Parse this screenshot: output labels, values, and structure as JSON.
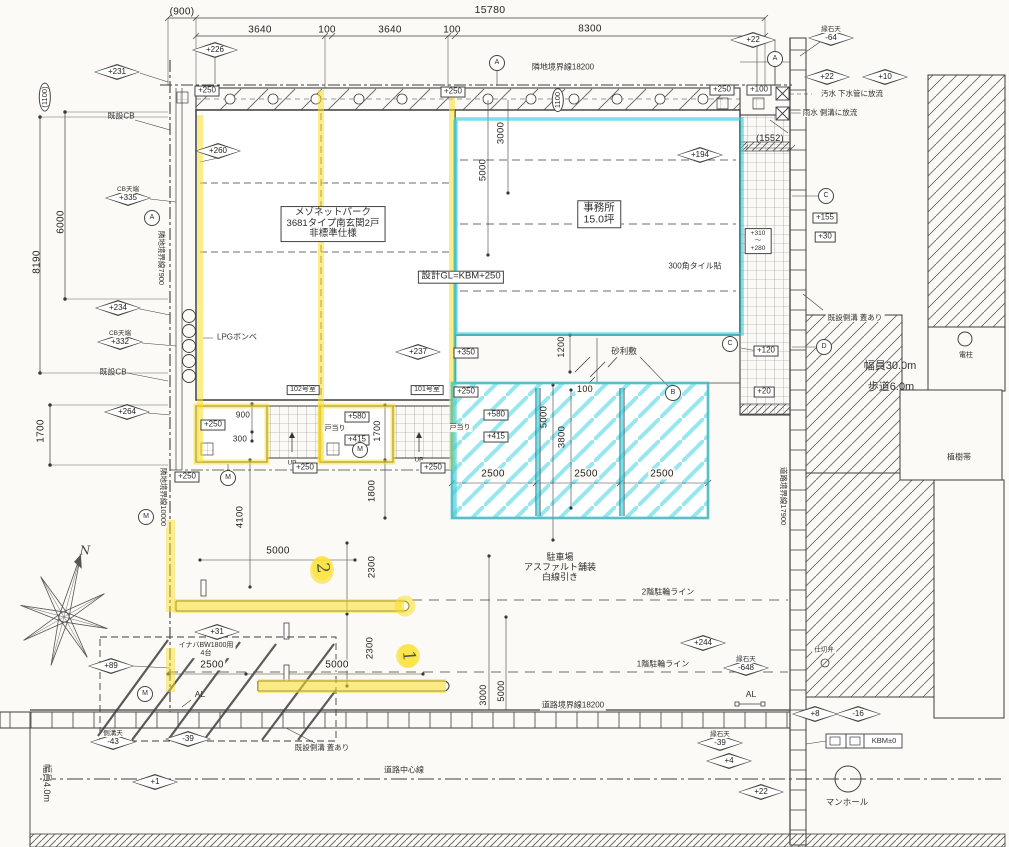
{
  "drawing": {
    "type": "site-plan",
    "accent_yellow": "#f8e23c",
    "accent_cyan": "#44d2e2",
    "line_color": "#3f3f3f"
  },
  "labels": [
    {
      "n": "dim-900",
      "t": "(900)",
      "x": 182,
      "y": 12,
      "k": "dim",
      "s": 10
    },
    {
      "n": "dim-15780",
      "t": "15780",
      "x": 490,
      "y": 11,
      "k": "dim",
      "s": 10.5
    },
    {
      "n": "dim-3640-a",
      "t": "3640",
      "x": 260,
      "y": 30,
      "k": "dim",
      "s": 10
    },
    {
      "n": "dim-100-a",
      "t": "100",
      "x": 327,
      "y": 30,
      "k": "dim",
      "s": 10
    },
    {
      "n": "dim-3640-b",
      "t": "3640",
      "x": 390,
      "y": 30,
      "k": "dim",
      "s": 10
    },
    {
      "n": "dim-100-b",
      "t": "100",
      "x": 452,
      "y": 30,
      "k": "dim",
      "s": 10
    },
    {
      "n": "dim-8300",
      "t": "8300",
      "x": 590,
      "y": 29,
      "k": "dim",
      "s": 10
    },
    {
      "n": "dim-1100-left",
      "t": "(1100)",
      "x": 45,
      "y": 97,
      "k": "oval",
      "r": -90
    },
    {
      "n": "dim-6000",
      "t": "6000",
      "x": 61,
      "y": 222,
      "k": "dim",
      "r": -90,
      "s": 10
    },
    {
      "n": "dim-8190",
      "t": "8190",
      "x": 37,
      "y": 262,
      "k": "dim",
      "r": -90,
      "s": 10
    },
    {
      "n": "dim-1700-left",
      "t": "1700",
      "x": 41,
      "y": 431,
      "k": "dim",
      "r": -90,
      "s": 10
    },
    {
      "n": "boundary-top",
      "t": "隣地境界線18200",
      "x": 563,
      "y": 68,
      "k": "note",
      "s": 8,
      "bg": 1
    },
    {
      "n": "boundary-left-upper",
      "t": "隣地境界線7900",
      "x": 161,
      "y": 258,
      "k": "note",
      "s": 7.5,
      "r": 90,
      "bg": 1
    },
    {
      "n": "boundary-left-lower",
      "t": "隣地境界線10000",
      "x": 163,
      "y": 497,
      "k": "note",
      "s": 7.5,
      "r": 90,
      "bg": 1
    },
    {
      "n": "boundary-right",
      "t": "道路境界線17900",
      "x": 783,
      "y": 496,
      "k": "note",
      "s": 7.5,
      "r": 90,
      "bg": 1
    },
    {
      "n": "boundary-bottom",
      "t": "道路境界線18200",
      "x": 573,
      "y": 706,
      "k": "note",
      "s": 8,
      "bg": 1
    },
    {
      "n": "road-centerline-label",
      "t": "道路中心線",
      "x": 404,
      "y": 771,
      "k": "note",
      "s": 8,
      "bg": 1
    },
    {
      "n": "road-width-bottom",
      "t": "幅員4.0m",
      "x": 47,
      "y": 783,
      "k": "note",
      "s": 9,
      "r": 90,
      "bg": 1
    },
    {
      "n": "road-width-right",
      "t": "幅員30.0m",
      "x": 890,
      "y": 366,
      "k": "note",
      "s": 11
    },
    {
      "n": "sidewalk-width",
      "t": "歩道6.0m",
      "x": 891,
      "y": 387,
      "k": "note",
      "s": 11
    },
    {
      "n": "building-title",
      "lines": [
        "メゾネットパーク",
        "3681タイプ南玄関2戸",
        "非標準仕様"
      ],
      "hl": 0,
      "x": 333,
      "y": 224,
      "k": "boxm",
      "s": 9.5
    },
    {
      "n": "office-label",
      "lines": [
        "事務所",
        "15.0坪"
      ],
      "x": 599,
      "y": 214,
      "k": "boxm",
      "s": 10.5
    },
    {
      "n": "design-gl",
      "t": "設計GL=KBM+250",
      "x": 461,
      "y": 277,
      "k": "box",
      "s": 9.5
    },
    {
      "n": "tile-note",
      "t": "300角タイル貼",
      "x": 695,
      "y": 267,
      "k": "note",
      "s": 8
    },
    {
      "n": "gravel-note",
      "t": "砂利敷",
      "x": 624,
      "y": 352,
      "k": "note",
      "s": 8.5,
      "bg": 1
    },
    {
      "n": "room-102",
      "t": "102号室",
      "x": 303,
      "y": 390,
      "k": "box",
      "s": 7
    },
    {
      "n": "room-101",
      "t": "101号室",
      "x": 427,
      "y": 390,
      "k": "box",
      "s": 7
    },
    {
      "n": "doorstop-102",
      "t": "戸当り",
      "x": 335,
      "y": 429,
      "k": "note",
      "s": 7,
      "bg": 1
    },
    {
      "n": "doorstop-101",
      "t": "戸当り",
      "x": 460,
      "y": 428,
      "k": "note",
      "s": 7,
      "bg": 1
    },
    {
      "n": "up-102",
      "t": "UP",
      "x": 292,
      "y": 463,
      "k": "note",
      "s": 6.5
    },
    {
      "n": "up-101",
      "t": "UP",
      "x": 419,
      "y": 460,
      "k": "note",
      "s": 6.5
    },
    {
      "n": "parking-label",
      "lines": [
        "駐車場",
        "アスファルト舗装",
        "白線引き"
      ],
      "x": 560,
      "y": 567,
      "k": "multi",
      "s": 9
    },
    {
      "n": "line-2f",
      "t": "2階駐輪ライン",
      "x": 668,
      "y": 593,
      "k": "note",
      "s": 8,
      "bg": 1
    },
    {
      "n": "line-1f",
      "t": "1階駐輪ライン",
      "x": 663,
      "y": 665,
      "k": "note",
      "s": 8,
      "bg": 1
    },
    {
      "n": "shed-label",
      "lines": [
        "イナバBW1800用",
        "4台"
      ],
      "x": 206,
      "y": 650,
      "k": "multi",
      "s": 7,
      "bg": 1
    },
    {
      "n": "lpg-label",
      "t": "LPGボンベ",
      "x": 237,
      "y": 338,
      "k": "note",
      "s": 8
    },
    {
      "n": "cb-top",
      "t": "既設CB",
      "x": 121,
      "y": 117,
      "k": "note",
      "s": 8
    },
    {
      "n": "cb-bottom",
      "t": "既設CB",
      "x": 113,
      "y": 373,
      "k": "note",
      "s": 8
    },
    {
      "n": "gutter-right",
      "t": "既設側溝 蓋あり",
      "x": 855,
      "y": 318,
      "k": "note",
      "s": 7.5,
      "bg": 1
    },
    {
      "n": "gutter-bottom",
      "t": "既設側溝 蓋あり",
      "x": 322,
      "y": 748,
      "k": "note",
      "s": 7.5,
      "bg": 1
    },
    {
      "n": "sewage-note",
      "t": "汚水 下水管に放流",
      "x": 852,
      "y": 94,
      "k": "note",
      "s": 7.5,
      "bg": 1
    },
    {
      "n": "rain-note",
      "t": "雨水 側溝に放流",
      "x": 830,
      "y": 113,
      "k": "note",
      "s": 7.5,
      "bg": 1
    },
    {
      "n": "planting-label",
      "t": "植樹帯",
      "x": 959,
      "y": 458,
      "k": "note",
      "s": 8
    },
    {
      "n": "pole-label",
      "t": "電柱",
      "x": 966,
      "y": 356,
      "k": "note",
      "s": 7
    },
    {
      "n": "manhole-label",
      "t": "マンホール",
      "x": 847,
      "y": 803,
      "k": "note",
      "s": 8.5
    },
    {
      "n": "valve-label",
      "t": "仕切弁",
      "x": 824,
      "y": 650,
      "k": "note",
      "s": 6.5,
      "bg": 1
    },
    {
      "n": "al-left",
      "t": "AL",
      "x": 200,
      "y": 695,
      "k": "note",
      "s": 8.5
    },
    {
      "n": "al-right",
      "t": "AL",
      "x": 751,
      "y": 695,
      "k": "note",
      "s": 8.5,
      "bg": 1
    },
    {
      "n": "kbm-label",
      "t": "KBM±0",
      "x": 884,
      "y": 741,
      "k": "note",
      "s": 7.5
    },
    {
      "n": "north-label",
      "t": "N",
      "x": 85,
      "y": 551,
      "k": "north",
      "s": 12
    },
    {
      "n": "lv-250-walk-1",
      "t": "+250",
      "x": 207,
      "y": 91,
      "k": "box"
    },
    {
      "n": "lv-250-walk-2",
      "t": "+250",
      "x": 453,
      "y": 92,
      "k": "box"
    },
    {
      "n": "lv-250-walk-3",
      "t": "+250",
      "x": 722,
      "y": 90,
      "k": "box"
    },
    {
      "n": "lv-100",
      "t": "+100",
      "x": 759,
      "y": 90,
      "k": "box"
    },
    {
      "n": "lv-155",
      "t": "+155",
      "x": 825,
      "y": 218,
      "k": "box"
    },
    {
      "n": "lv-30",
      "t": "+30",
      "x": 825,
      "y": 237,
      "k": "box"
    },
    {
      "n": "lv-310-280",
      "lines": [
        "+310",
        "〜",
        "+280"
      ],
      "x": 758,
      "y": 241,
      "k": "boxm",
      "s": 6.5
    },
    {
      "n": "lv-120",
      "t": "+120",
      "x": 766,
      "y": 351,
      "k": "box"
    },
    {
      "n": "lv-20",
      "t": "+20",
      "x": 764,
      "y": 392,
      "k": "box"
    },
    {
      "n": "lv-350",
      "t": "+350",
      "x": 466,
      "y": 353,
      "k": "box"
    },
    {
      "n": "lv-250-park",
      "t": "+250",
      "x": 466,
      "y": 392,
      "k": "box"
    },
    {
      "n": "lv-580-101",
      "t": "+580",
      "x": 496,
      "y": 415,
      "k": "box"
    },
    {
      "n": "lv-415-101",
      "t": "+415",
      "x": 496,
      "y": 437,
      "k": "box"
    },
    {
      "n": "lv-250-porch-l",
      "t": "+250",
      "x": 213,
      "y": 425,
      "k": "box"
    },
    {
      "n": "lv-580-102",
      "t": "+580",
      "x": 357,
      "y": 417,
      "k": "box"
    },
    {
      "n": "lv-415-102",
      "t": "+415",
      "x": 357,
      "y": 440,
      "k": "box"
    },
    {
      "n": "lv-250-102",
      "t": "+250",
      "x": 305,
      "y": 468,
      "k": "box"
    },
    {
      "n": "lv-250-101",
      "t": "+250",
      "x": 433,
      "y": 468,
      "k": "box"
    },
    {
      "n": "lv-250-porch-l2",
      "t": "+250",
      "x": 187,
      "y": 477,
      "k": "box"
    },
    {
      "n": "dim-1100-walk",
      "t": "1100",
      "x": 558,
      "y": 100,
      "k": "oval",
      "r": -90
    },
    {
      "n": "dim-3000-top",
      "t": "3000",
      "x": 502,
      "y": 133,
      "k": "dim",
      "r": -90,
      "s": 9.5
    },
    {
      "n": "dim-5000-top",
      "t": "5000",
      "x": 484,
      "y": 170,
      "k": "dim",
      "r": -90,
      "s": 9.5
    },
    {
      "n": "dim-1200",
      "t": "1200",
      "x": 561,
      "y": 347,
      "k": "dim",
      "r": -90,
      "s": 9
    },
    {
      "n": "dim-100-gravel",
      "t": "100",
      "x": 585,
      "y": 389,
      "k": "dim",
      "s": 9,
      "bg": 1
    },
    {
      "n": "dim-5000-park",
      "t": "5000",
      "x": 545,
      "y": 417,
      "k": "dim",
      "r": -90,
      "s": 9.5
    },
    {
      "n": "dim-3800",
      "t": "3800",
      "x": 563,
      "y": 437,
      "k": "dim",
      "r": -90,
      "s": 9.5
    },
    {
      "n": "dim-2500-a",
      "t": "2500",
      "x": 493,
      "y": 474,
      "k": "dim",
      "s": 10,
      "bg": 1
    },
    {
      "n": "dim-2500-b",
      "t": "2500",
      "x": 586,
      "y": 474,
      "k": "dim",
      "s": 10,
      "bg": 1
    },
    {
      "n": "dim-2500-c",
      "t": "2500",
      "x": 662,
      "y": 474,
      "k": "dim",
      "s": 10,
      "bg": 1
    },
    {
      "n": "dim-900-porch",
      "t": "900",
      "x": 243,
      "y": 416,
      "k": "dim",
      "s": 8
    },
    {
      "n": "dim-300-porch",
      "t": "300",
      "x": 240,
      "y": 440,
      "k": "dim",
      "s": 8
    },
    {
      "n": "dim-1700-entry",
      "t": "1700",
      "x": 377,
      "y": 431,
      "k": "dim",
      "r": -90,
      "s": 9
    },
    {
      "n": "dim-1800",
      "t": "1800",
      "x": 373,
      "y": 491,
      "k": "dim",
      "r": -90,
      "s": 9.5
    },
    {
      "n": "dim-4100",
      "t": "4100",
      "x": 241,
      "y": 517,
      "k": "dim",
      "r": -90,
      "s": 9.5
    },
    {
      "n": "dim-5000-drive-a",
      "t": "5000",
      "x": 278,
      "y": 551,
      "k": "dim",
      "s": 10,
      "bg": 1
    },
    {
      "n": "dim-2300-a",
      "t": "2300",
      "x": 373,
      "y": 567,
      "k": "dim",
      "r": -90,
      "s": 9.5
    },
    {
      "n": "dim-2300-b",
      "t": "2300",
      "x": 371,
      "y": 648,
      "k": "dim",
      "r": -90,
      "s": 9.5
    },
    {
      "n": "dim-2500-shed",
      "t": "2500",
      "x": 212,
      "y": 665,
      "k": "dim",
      "s": 10,
      "bg": 1
    },
    {
      "n": "dim-5000-drive-b",
      "t": "5000",
      "x": 337,
      "y": 665,
      "k": "dim",
      "s": 10,
      "bg": 1
    },
    {
      "n": "dim-3000-exit",
      "t": "3000",
      "x": 483,
      "y": 695,
      "k": "dim",
      "r": -90,
      "s": 9
    },
    {
      "n": "dim-5000-exit",
      "t": "5000",
      "x": 501,
      "y": 691,
      "k": "dim",
      "r": -90,
      "s": 9
    },
    {
      "n": "dim-1552",
      "t": "(1552)",
      "x": 770,
      "y": 138,
      "k": "dim",
      "s": 9
    },
    {
      "n": "spot-226",
      "t": "+226",
      "x": 215,
      "y": 50,
      "k": "diamond"
    },
    {
      "n": "spot-231",
      "t": "+231",
      "x": 117,
      "y": 72,
      "k": "diamond"
    },
    {
      "n": "spot-260",
      "t": "+260",
      "x": 218,
      "y": 151,
      "k": "diamond"
    },
    {
      "n": "spot-335",
      "t": "+335",
      "x": 128,
      "y": 198,
      "k": "diamond",
      "tag": "CB天端"
    },
    {
      "n": "spot-234",
      "t": "+234",
      "x": 118,
      "y": 308,
      "k": "diamond"
    },
    {
      "n": "spot-332",
      "t": "+332",
      "x": 120,
      "y": 342,
      "k": "diamond",
      "tag": "CB天端"
    },
    {
      "n": "spot-194",
      "t": "+194",
      "x": 700,
      "y": 155,
      "k": "diamond"
    },
    {
      "n": "spot-237",
      "t": "+237",
      "x": 418,
      "y": 352,
      "k": "diamond"
    },
    {
      "n": "spot-264",
      "t": "+264",
      "x": 127,
      "y": 412,
      "k": "diamond"
    },
    {
      "n": "spot-89",
      "t": "+89",
      "x": 111,
      "y": 666,
      "k": "diamond"
    },
    {
      "n": "spot-31",
      "t": "+31",
      "x": 217,
      "y": 632,
      "k": "diamond"
    },
    {
      "n": "spot-244",
      "t": "+244",
      "x": 703,
      "y": 643,
      "k": "diamond"
    },
    {
      "n": "spot-648",
      "t": "-648",
      "x": 746,
      "y": 668,
      "k": "diamond",
      "tag": "縁石天"
    },
    {
      "n": "spot-43",
      "t": "-43",
      "x": 113,
      "y": 742,
      "k": "diamond",
      "tag": "側溝天"
    },
    {
      "n": "spot-39-a",
      "t": "-39",
      "x": 188,
      "y": 739,
      "k": "diamond"
    },
    {
      "n": "spot-1",
      "t": "+1",
      "x": 155,
      "y": 782,
      "k": "diamond"
    },
    {
      "n": "spot-39-b",
      "t": "-39",
      "x": 720,
      "y": 743,
      "k": "diamond",
      "tag": "縁石天"
    },
    {
      "n": "spot-4",
      "t": "+4",
      "x": 729,
      "y": 761,
      "k": "diamond"
    },
    {
      "n": "spot-22-a",
      "t": "+22",
      "x": 761,
      "y": 792,
      "k": "diamond"
    },
    {
      "n": "spot-8",
      "t": "+8",
      "x": 815,
      "y": 714,
      "k": "diamond"
    },
    {
      "n": "spot-16",
      "t": "-16",
      "x": 858,
      "y": 714,
      "k": "diamond"
    },
    {
      "n": "spot-22-b",
      "t": "+22",
      "x": 827,
      "y": 77,
      "k": "diamond"
    },
    {
      "n": "spot-64",
      "t": "-64",
      "x": 831,
      "y": 38,
      "k": "diamond",
      "tag": "縁石天"
    },
    {
      "n": "spot-10",
      "t": "+10",
      "x": 885,
      "y": 77,
      "k": "diamond"
    },
    {
      "n": "spot-22-c",
      "t": "+22",
      "x": 753,
      "y": 40,
      "k": "diamond"
    },
    {
      "n": "grid-a-top",
      "t": "A",
      "x": 497,
      "y": 63,
      "k": "bubble"
    },
    {
      "n": "grid-a-right",
      "t": "A",
      "x": 775,
      "y": 59,
      "k": "bubble"
    },
    {
      "n": "grid-a-left",
      "t": "A",
      "x": 152,
      "y": 218,
      "k": "bubble"
    },
    {
      "n": "meter-left-1",
      "t": "M",
      "x": 146,
      "y": 517,
      "k": "bubble"
    },
    {
      "n": "meter-left-2",
      "t": "M",
      "x": 145,
      "y": 694,
      "k": "bubble"
    },
    {
      "n": "meter-porch-l",
      "t": "M",
      "x": 228,
      "y": 478,
      "k": "bubble"
    },
    {
      "n": "meter-porch-m",
      "t": "M",
      "x": 360,
      "y": 450,
      "k": "bubble"
    },
    {
      "n": "grid-b",
      "t": "B",
      "x": 673,
      "y": 393,
      "k": "bubble"
    },
    {
      "n": "grid-c-1",
      "t": "C",
      "x": 730,
      "y": 344,
      "k": "bubble"
    },
    {
      "n": "grid-c-2",
      "t": "C",
      "x": 826,
      "y": 196,
      "k": "bubble"
    },
    {
      "n": "grid-d",
      "t": "D",
      "x": 824,
      "y": 347,
      "k": "bubble"
    },
    {
      "n": "note-2",
      "t": "2",
      "x": 322,
      "y": 568,
      "k": "mark",
      "r": 85
    },
    {
      "n": "note-1",
      "t": "1",
      "x": 408,
      "y": 656,
      "k": "mark",
      "r": 85
    }
  ]
}
